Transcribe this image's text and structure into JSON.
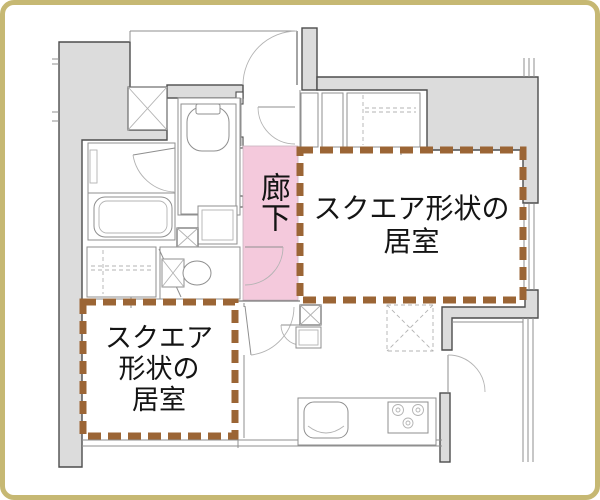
{
  "colors": {
    "frame_border": "#c6b873",
    "background": "#ffffff",
    "wall_fill": "#dcdcdc",
    "wall_stroke": "#4d4d4d",
    "thin_line": "#8f8f8f",
    "corridor_highlight": "#f4c9dc",
    "annotation_dash": "#9b6535",
    "label_text": "#141414"
  },
  "labels": {
    "corridor": "廊下",
    "room_right": {
      "full": "スクエア形状の居室",
      "line1": "スクエア形状の",
      "line2": "居室"
    },
    "room_left": {
      "full": "スクエア形状の居室",
      "line1": "スクエア",
      "line2": "形状の",
      "line3": "居室"
    }
  },
  "fixtures": [
    "entrance-door",
    "pipe-space",
    "shoe-cabinet",
    "closet",
    "wash-basin",
    "bathtub",
    "bathroom-door",
    "washing-machine-space",
    "toilet",
    "corridor-doors",
    "living-room-doors",
    "storage-box",
    "range-hood",
    "kitchen-sink",
    "gas-stove",
    "balcony-door",
    "windows"
  ]
}
